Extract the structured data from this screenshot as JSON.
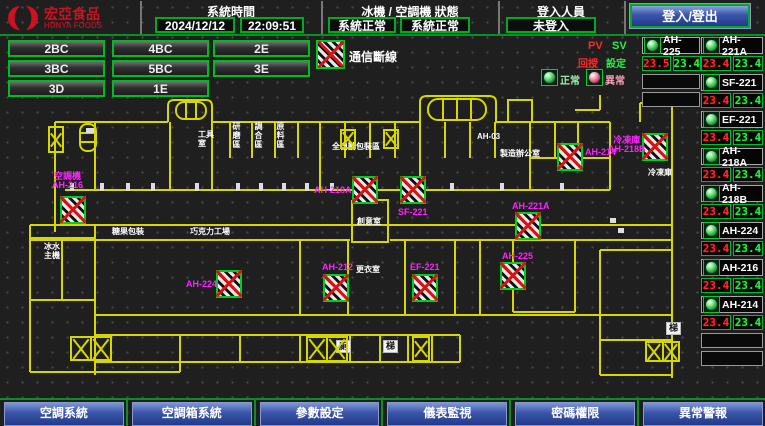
{
  "header": {
    "logo_title": "宏亞食品",
    "logo_subtitle": "HUNYA FOODS",
    "system_time_label": "系統時間",
    "date": "2024/12/12",
    "time": "22:09:51",
    "status_label": "冰機 / 空調機 狀態",
    "chiller_status": "系統正常",
    "ac_status": "系統正常",
    "login_label": "登入人員",
    "login_status": "未登入",
    "login_button": "登入/登出"
  },
  "floors": [
    "2BC",
    "4BC",
    "2E",
    "3BC",
    "5BC",
    "3E",
    "3D",
    "1E"
  ],
  "legend": {
    "comm_fail": "通信斷線",
    "pv": "PV",
    "sv": "SV",
    "pv_label": "回授",
    "sv_label": "設定",
    "normal": "正常",
    "abnormal": "異常"
  },
  "units_col_a": [
    {
      "id": "AH-225",
      "pv": "23.5",
      "sv": "23.4"
    }
  ],
  "units_col_b": [
    {
      "id": "AH-221A",
      "pv": "23.4",
      "sv": "23.4"
    },
    {
      "id": "SF-221",
      "pv": "23.4",
      "sv": "23.4"
    },
    {
      "id": "EF-221",
      "pv": "23.4",
      "sv": "23.4"
    },
    {
      "id": "AH-218A",
      "pv": "23.4",
      "sv": "23.4"
    },
    {
      "id": "AH-218B",
      "pv": "23.4",
      "sv": "23.4"
    },
    {
      "id": "AH-224",
      "pv": "23.4",
      "sv": "23.4"
    },
    {
      "id": "AH-216",
      "pv": "23.4",
      "sv": "23.4"
    },
    {
      "id": "AH-214",
      "pv": "23.4",
      "sv": "23.4"
    }
  ],
  "plan": {
    "markers": [
      {
        "x": 60,
        "y": 196,
        "label": "AH-216",
        "lines": "空調機\nAH-216",
        "lx": 52,
        "ly": 172
      },
      {
        "x": 352,
        "y": 176,
        "label": "AH-218A",
        "lines": "AH-218A",
        "lx": 314,
        "ly": 186
      },
      {
        "x": 400,
        "y": 176,
        "label": "SF-221",
        "lines": "SF-221",
        "lx": 398,
        "ly": 208
      },
      {
        "x": 515,
        "y": 212,
        "label": "AH-221A",
        "lines": "AH-221A",
        "lx": 512,
        "ly": 202
      },
      {
        "x": 500,
        "y": 262,
        "label": "AH-225",
        "lines": "AH-225",
        "lx": 502,
        "ly": 252
      },
      {
        "x": 557,
        "y": 143,
        "label": "AH-214",
        "lines": "AH-214",
        "lx": 585,
        "ly": 148
      },
      {
        "x": 642,
        "y": 133,
        "label": "AH-218B",
        "lines": "冷凍庫\nAH-218B",
        "lx": 608,
        "ly": 136
      },
      {
        "x": 216,
        "y": 270,
        "label": "AH-224",
        "lines": "AH-224",
        "lx": 186,
        "ly": 280
      },
      {
        "x": 323,
        "y": 274,
        "label": "AH-212",
        "lines": "AH-212",
        "lx": 322,
        "ly": 263
      },
      {
        "x": 412,
        "y": 274,
        "label": "EF-221",
        "lines": "EF-221",
        "lx": 410,
        "ly": 263
      }
    ],
    "rooms": [
      {
        "t": "工具\n室",
        "x": 198,
        "y": 130
      },
      {
        "t": "全自動包裝區",
        "x": 332,
        "y": 142
      },
      {
        "t": "研磨區",
        "x": 232,
        "y": 122,
        "vert": true
      },
      {
        "t": "調合區",
        "x": 254,
        "y": 122,
        "vert": true
      },
      {
        "t": "原料區",
        "x": 276,
        "y": 122,
        "vert": true
      },
      {
        "t": "AH-03",
        "x": 477,
        "y": 132
      },
      {
        "t": "製造辦公室",
        "x": 500,
        "y": 149
      },
      {
        "t": "創意室",
        "x": 357,
        "y": 217
      },
      {
        "t": "更衣室",
        "x": 356,
        "y": 265
      },
      {
        "t": "冰水\n主機",
        "x": 44,
        "y": 242
      },
      {
        "t": "糖果包裝",
        "x": 112,
        "y": 227
      },
      {
        "t": "巧克力工場",
        "x": 190,
        "y": 227
      },
      {
        "t": "冷凍庫",
        "x": 648,
        "y": 168
      },
      {
        "t": "廁",
        "x": 336,
        "y": 340,
        "boxed": true
      },
      {
        "t": "梯",
        "x": 383,
        "y": 340,
        "boxed": true
      },
      {
        "t": "梯",
        "x": 666,
        "y": 322,
        "boxed": true
      }
    ],
    "stairs": [
      {
        "x": 48,
        "y": 126,
        "w": 16,
        "h": 27,
        "cells": 1
      },
      {
        "x": 340,
        "y": 129,
        "w": 16,
        "h": 20,
        "cells": 1
      },
      {
        "x": 383,
        "y": 129,
        "w": 16,
        "h": 20,
        "cells": 1
      },
      {
        "x": 306,
        "y": 336,
        "w": 42,
        "h": 26,
        "cells": 2
      },
      {
        "x": 412,
        "y": 336,
        "w": 18,
        "h": 26,
        "cells": 1
      },
      {
        "x": 70,
        "y": 336,
        "w": 42,
        "h": 25,
        "cells": 2
      },
      {
        "x": 645,
        "y": 341,
        "w": 35,
        "h": 21,
        "cells": 2
      }
    ]
  },
  "bottom_nav": [
    "空調系統",
    "空調箱系統",
    "參數設定",
    "儀表監視",
    "密碼權限",
    "異常警報"
  ],
  "colors": {
    "accent_green": "#00bb22",
    "magenta": "#ff22ff",
    "plan_yellow": "#d6d600",
    "alarm_red": "#dd2222",
    "button_blue": "#3a55a8"
  }
}
